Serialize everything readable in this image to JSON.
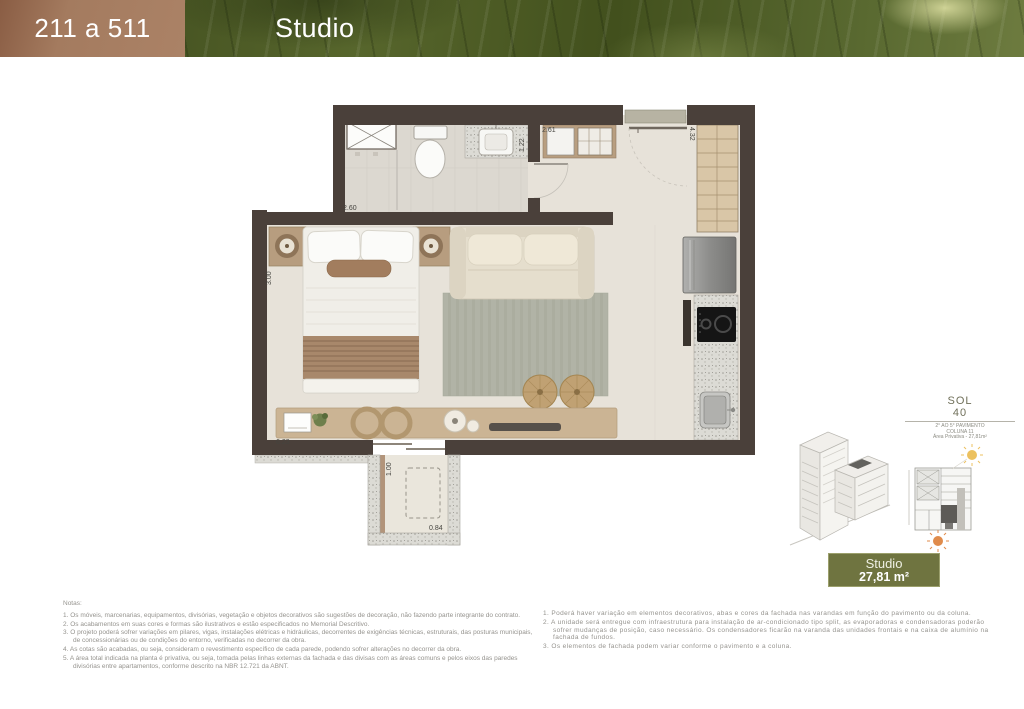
{
  "header": {
    "unit_range": "211 a 511",
    "title": "Studio"
  },
  "plan": {
    "dims": {
      "bath_width": "2.60",
      "bath_depth": "1.22",
      "entry_width": "2.61",
      "closet_height": "4.32",
      "bed_depth": "3.00",
      "room_width": "6.23",
      "balcony_depth": "1.00",
      "balcony_width": "0.84"
    }
  },
  "info": {
    "logo_top": "SOL",
    "logo_bottom": "40",
    "caption_lines": [
      "2° AO 5° PAVIMENTO",
      "COLUNA 11",
      "Área Privativa - 27,81m²"
    ],
    "badge": {
      "name": "Studio",
      "area": "27,81 m²"
    }
  },
  "notes_left": {
    "title": "Notas:",
    "items": [
      "1. Os móveis, marcenarias, equipamentos, divisórias, vegetação e objetos decorativos são sugestões de decoração, não fazendo parte integrante do contrato.",
      "2. Os acabamentos em suas cores e formas são ilustrativos e estão especificados no Memorial Descritivo.",
      "3. O projeto poderá sofrer variações em pilares, vigas, instalações elétricas e hidráulicas, decorrentes de exigências técnicas, estruturais, das posturas municipais, de concessionárias ou de condições do entorno, verificadas no decorrer da obra.",
      "4. As cotas são acabadas, ou seja, consideram o revestimento específico de cada parede, podendo sofrer alterações no decorrer da obra.",
      "5. A área total indicada na planta é privativa, ou seja, tomada pelas linhas externas da fachada e das divisas com as áreas comuns e pelos eixos das paredes divisórias entre apartamentos, conforme descrito na NBR 12.721 da ABNT."
    ]
  },
  "notes_right": {
    "items": [
      "1. Poderá haver variação em elementos decorativos, abas e cores da fachada nas varandas em função do pavimento ou da coluna.",
      "2. A unidade será entregue com infraestrutura para instalação de ar-condicionado tipo split, as evaporadoras e condensadoras poderão sofrer mudanças de posição, caso necessário. Os condensadores ficarão na varanda das unidades frontais e na caixa de alumínio na fachada de fundos.",
      "3. Os elementos de fachada podem variar conforme o pavimento e a coluna."
    ]
  },
  "colors": {
    "header_brown": "#a47b5f",
    "leaf_green": "#47521f",
    "badge_green": "#6f7440",
    "wall": "#4a403a",
    "wood": "#cbb494",
    "sun_yellow": "#ecc15f",
    "sun_orange": "#e08b4b"
  }
}
